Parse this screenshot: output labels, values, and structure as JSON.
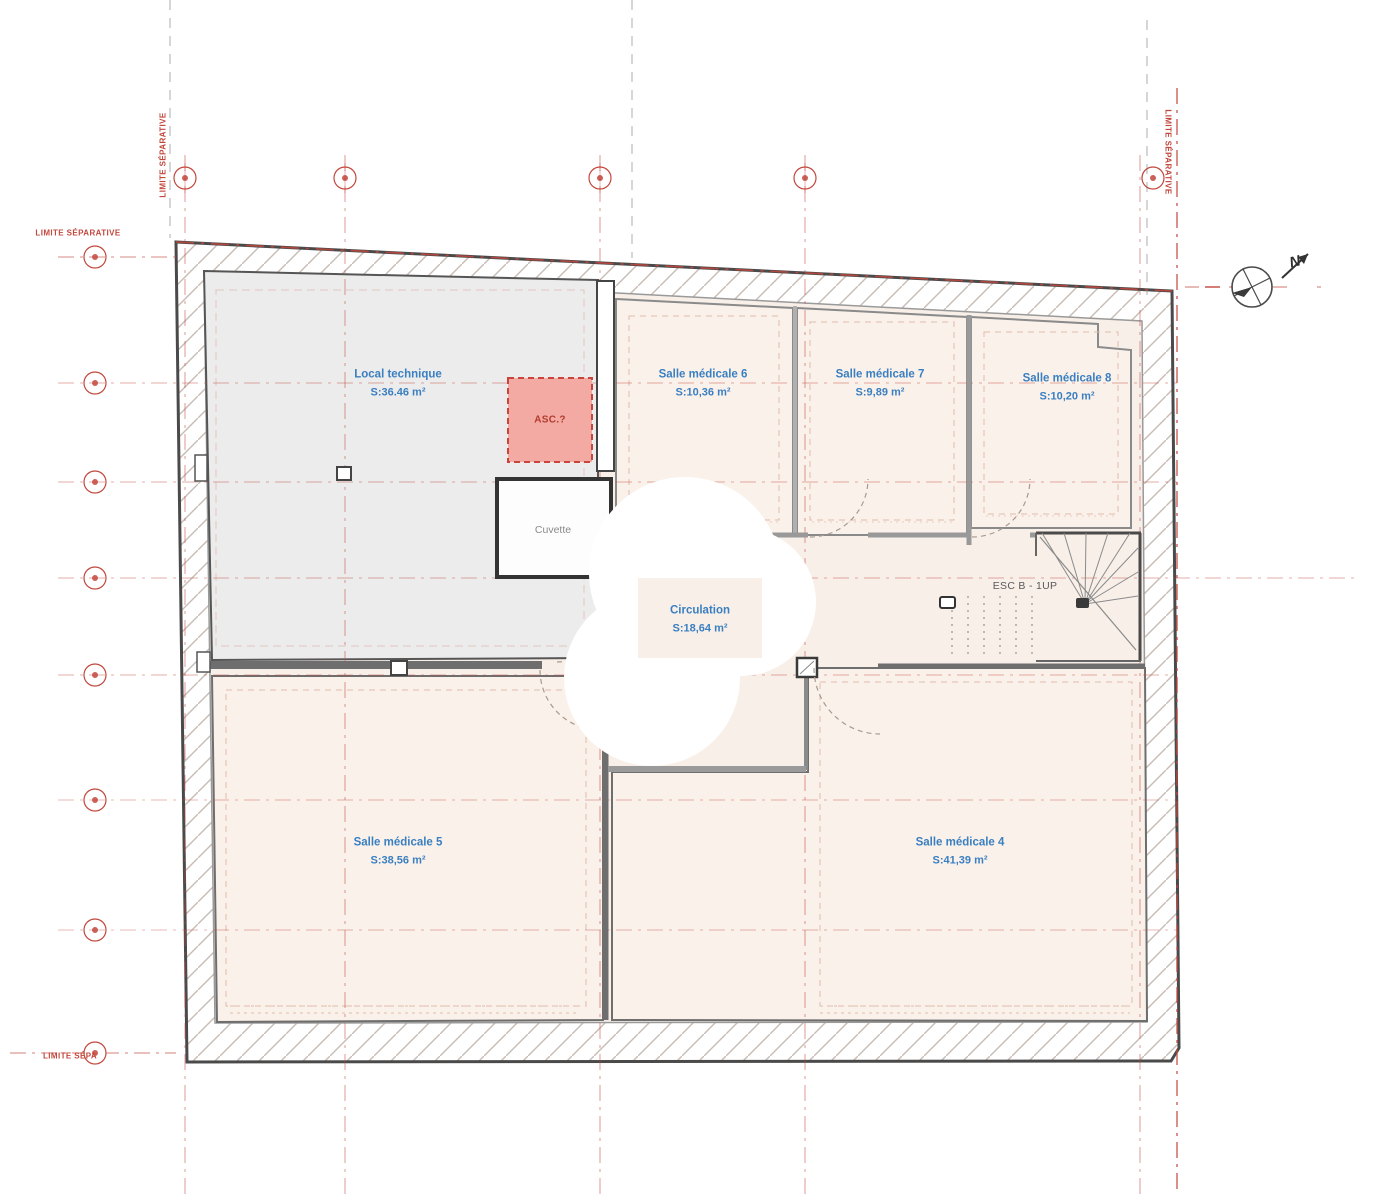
{
  "rooms": {
    "local_technique": {
      "name": "Local technique",
      "area": "S:36.46 m²"
    },
    "salle6": {
      "name": "Salle médicale 6",
      "area": "S:10,36 m²"
    },
    "salle7": {
      "name": "Salle médicale 7",
      "area": "S:9,89 m²"
    },
    "salle8": {
      "name": "Salle médicale 8",
      "area": "S:10,20 m²"
    },
    "circulation": {
      "name": "Circulation",
      "area": "S:18,64 m²"
    },
    "salle5": {
      "name": "Salle médicale 5",
      "area": "S:38,56 m²"
    },
    "salle4": {
      "name": "Salle médicale 4",
      "area": "S:41,39 m²"
    }
  },
  "fixtures": {
    "elevator_label": "ASC.?",
    "pit_label": "Cuvette",
    "stair_label": "ESC B - 1UP",
    "north_label": "N"
  },
  "boundaries": {
    "limite_left_vertical": "LIMITE SÉPARATIVE",
    "limite_left_horizontal": "LIMITE SÉPARATIVE",
    "limite_right_vertical": "LIMITE SÉPARATIVE",
    "limite_bottom": "LIMITE SÉPA"
  },
  "colors": {
    "grid_red": "#c2473d",
    "label_blue": "#3a7fc1",
    "wall_dark": "#4a4a4a",
    "room_fill": "#faf1ea",
    "technical_fill": "#ececec",
    "elevator_fill": "#f2aaa2"
  }
}
